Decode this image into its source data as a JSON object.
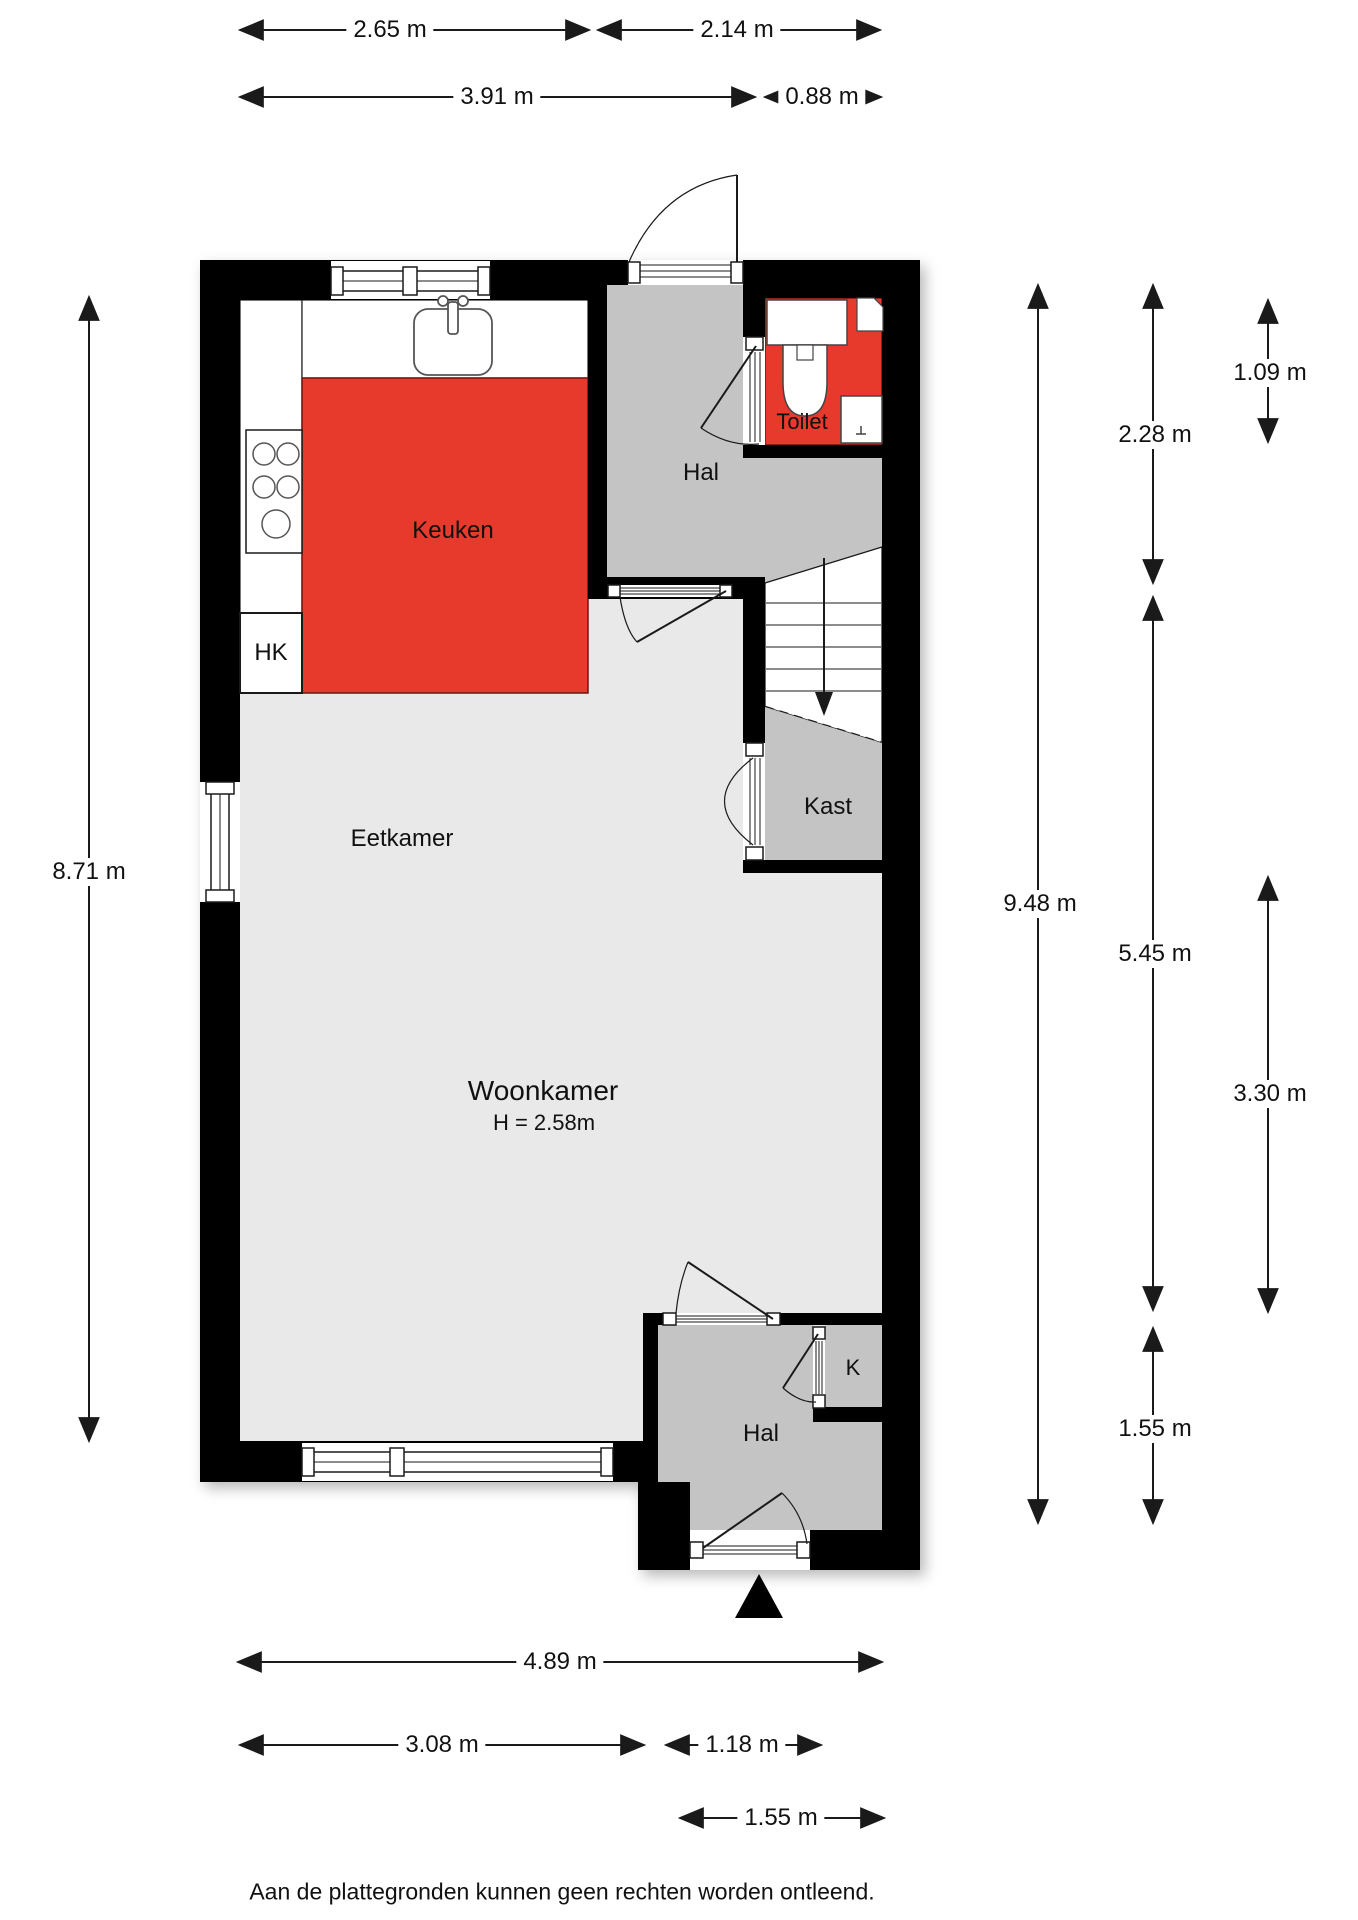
{
  "rooms": {
    "keuken": "Keuken",
    "hal_top": "Hal",
    "toilet": "Toilet",
    "hk": "HK",
    "kast": "Kast",
    "eetkamer": "Eetkamer",
    "woonkamer": "Woonkamer",
    "woonkamer_height": "H = 2.58m",
    "hal_bottom": "Hal",
    "k": "K"
  },
  "dimensions": {
    "d265": "2.65 m",
    "d214": "2.14 m",
    "d391": "3.91 m",
    "d088": "0.88 m",
    "d871": "8.71 m",
    "d948": "9.48 m",
    "d228": "2.28 m",
    "d109": "1.09 m",
    "d545": "5.45 m",
    "d330": "3.30 m",
    "d155_right": "1.55 m",
    "d489": "4.89 m",
    "d308": "3.08 m",
    "d118": "1.18 m",
    "d155_bottom": "1.55 m"
  },
  "icons": {
    "entrance_marker": "filled-triangle-entrance",
    "stairs_direction": "arrow-down"
  },
  "colors": {
    "wall": "#000000",
    "accent_red": "#e8392d",
    "accent_red_edge": "#6e1510",
    "room_gray": "#c4c4c4",
    "floor_light": "#e9e9e9",
    "background": "#ffffff"
  },
  "footer": {
    "disclaimer": "Aan de plattegronden kunnen geen rechten worden ontleend."
  }
}
